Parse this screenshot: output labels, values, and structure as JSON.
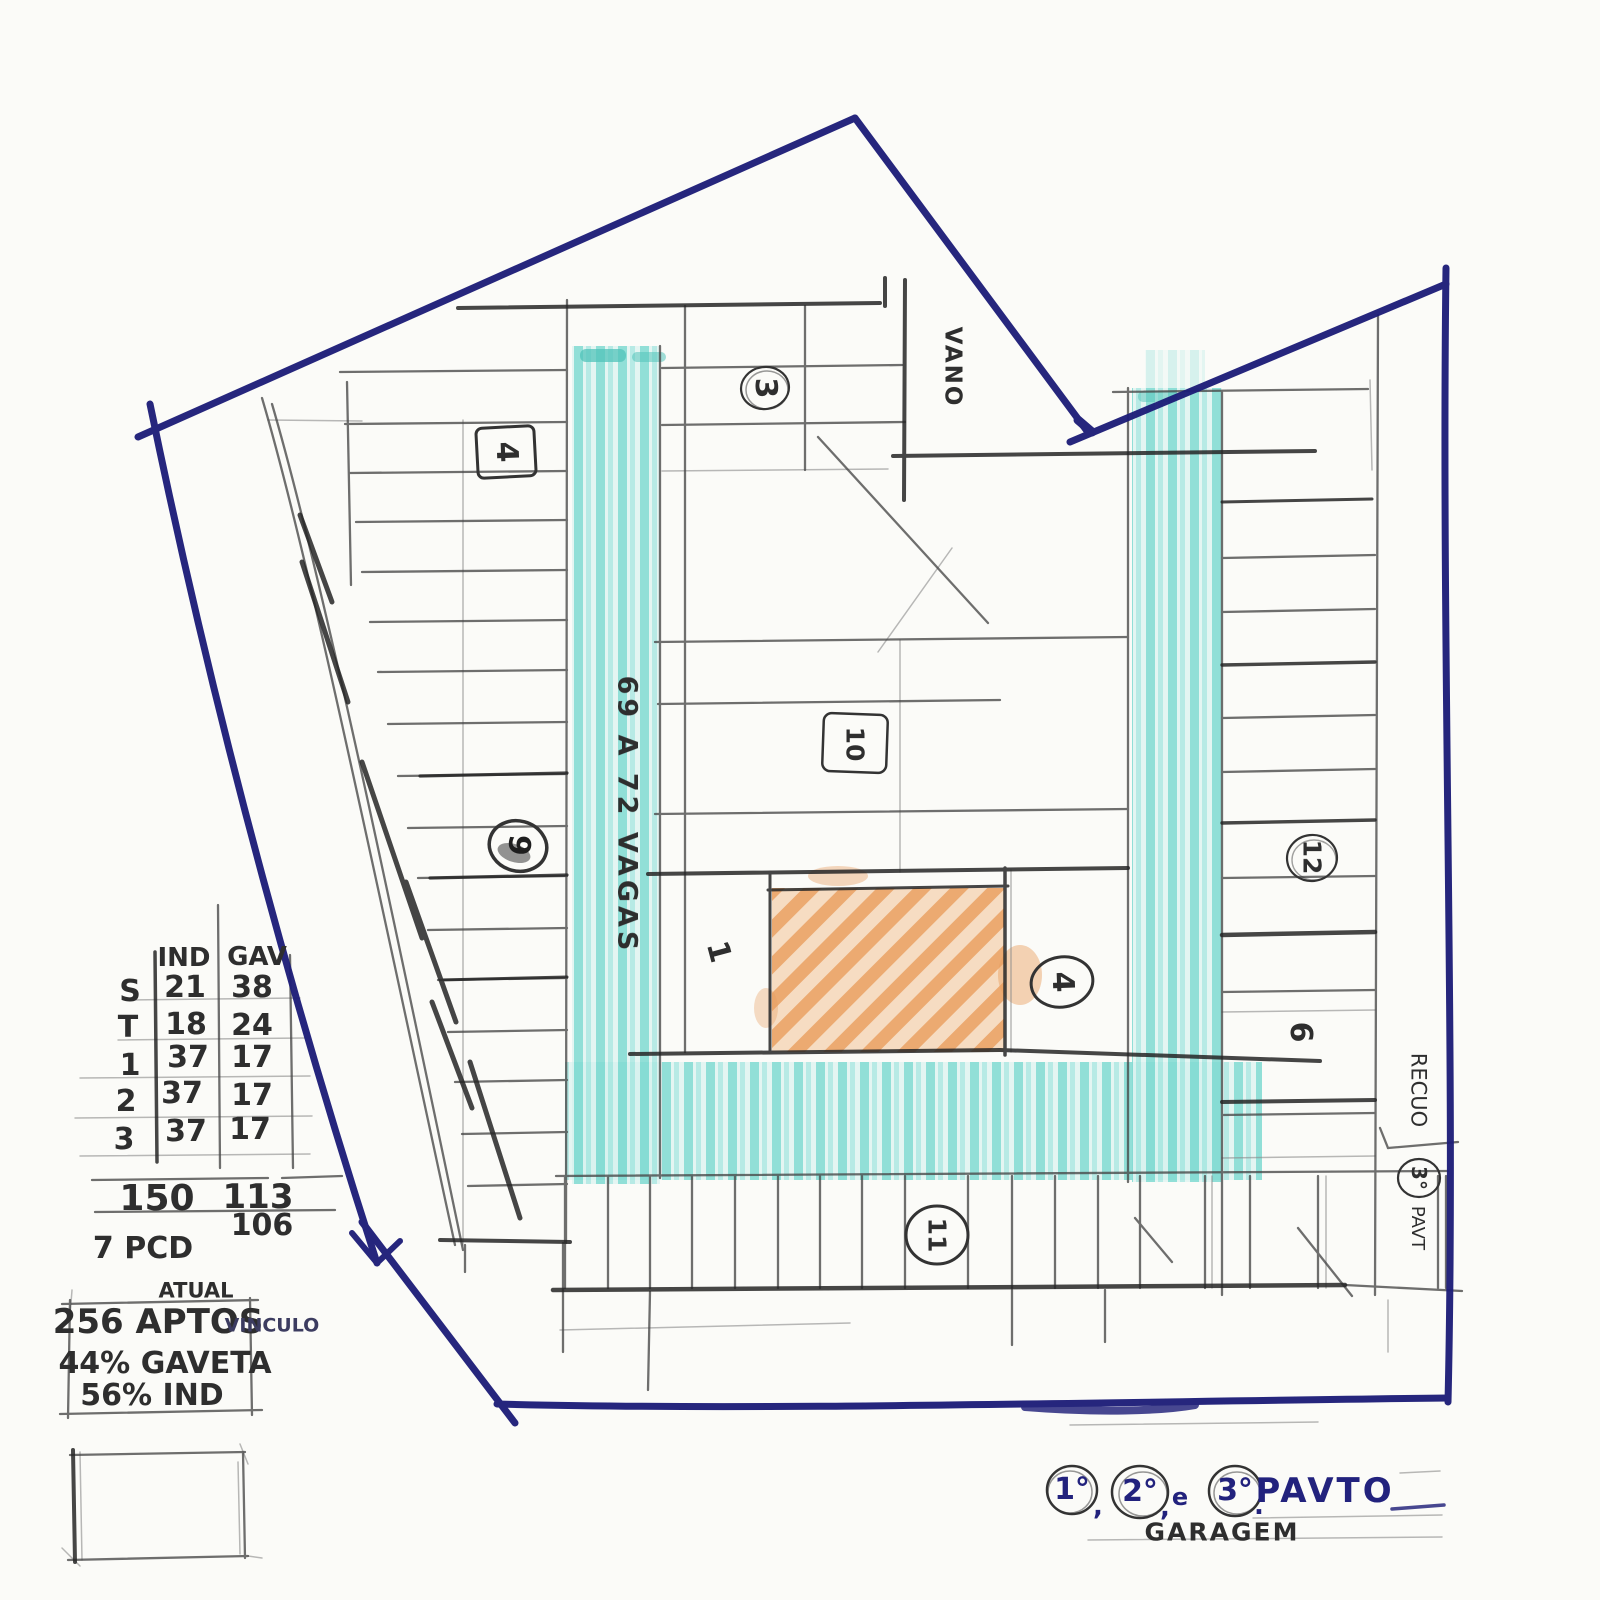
{
  "stats_table": {
    "col_ind": "IND",
    "col_gav": "GAV",
    "rows": [
      {
        "label": "S",
        "ind": "21",
        "gav": "38"
      },
      {
        "label": "T",
        "ind": "18",
        "gav": "24"
      },
      {
        "label": "1",
        "ind": "37",
        "gav": "17"
      },
      {
        "label": "2",
        "ind": "37",
        "gav": "17"
      },
      {
        "label": "3",
        "ind": "37",
        "gav": "17"
      }
    ],
    "total_ind": "150",
    "total_gav": "113",
    "total_gav_alt": "106",
    "pcd_note": "7 PCD"
  },
  "summary_box": {
    "header": "ATUAL",
    "apts": "256 APTOS",
    "apts_note": "VINCULO",
    "gaveta_pct": "44% GAVETA",
    "ind_pct": "56% IND"
  },
  "plan": {
    "lane_label": "69 A 72 VAGAS",
    "void_label": "VANO",
    "setback_label": "RECUO",
    "setback_floor": "3°",
    "setback_floor_suffix": "PAVT",
    "markers": [
      {
        "id": "zone-3",
        "label": "3"
      },
      {
        "id": "zone-4-box",
        "label": "4"
      },
      {
        "id": "zone-10",
        "label": "10"
      },
      {
        "id": "zone-9",
        "label": "9"
      },
      {
        "id": "zone-12",
        "label": "12"
      },
      {
        "id": "zone-1",
        "label": "1"
      },
      {
        "id": "zone-4-circle",
        "label": "4"
      },
      {
        "id": "zone-6",
        "label": "6"
      },
      {
        "id": "zone-11",
        "label": "11"
      }
    ]
  },
  "title_block": {
    "floor1": "1°",
    "sep1": ",",
    "floor2": "2°",
    "sep2": ",",
    "conj": "e",
    "floor3": "3°",
    "sep3": ".",
    "title": "PAVTO",
    "subtitle": "GARAGEM"
  },
  "colors": {
    "ink": "#22227d",
    "pencil": "#2e2e2e",
    "highlight_cyan": "#7cd9d1",
    "highlight_orange": "#e89d5e"
  }
}
